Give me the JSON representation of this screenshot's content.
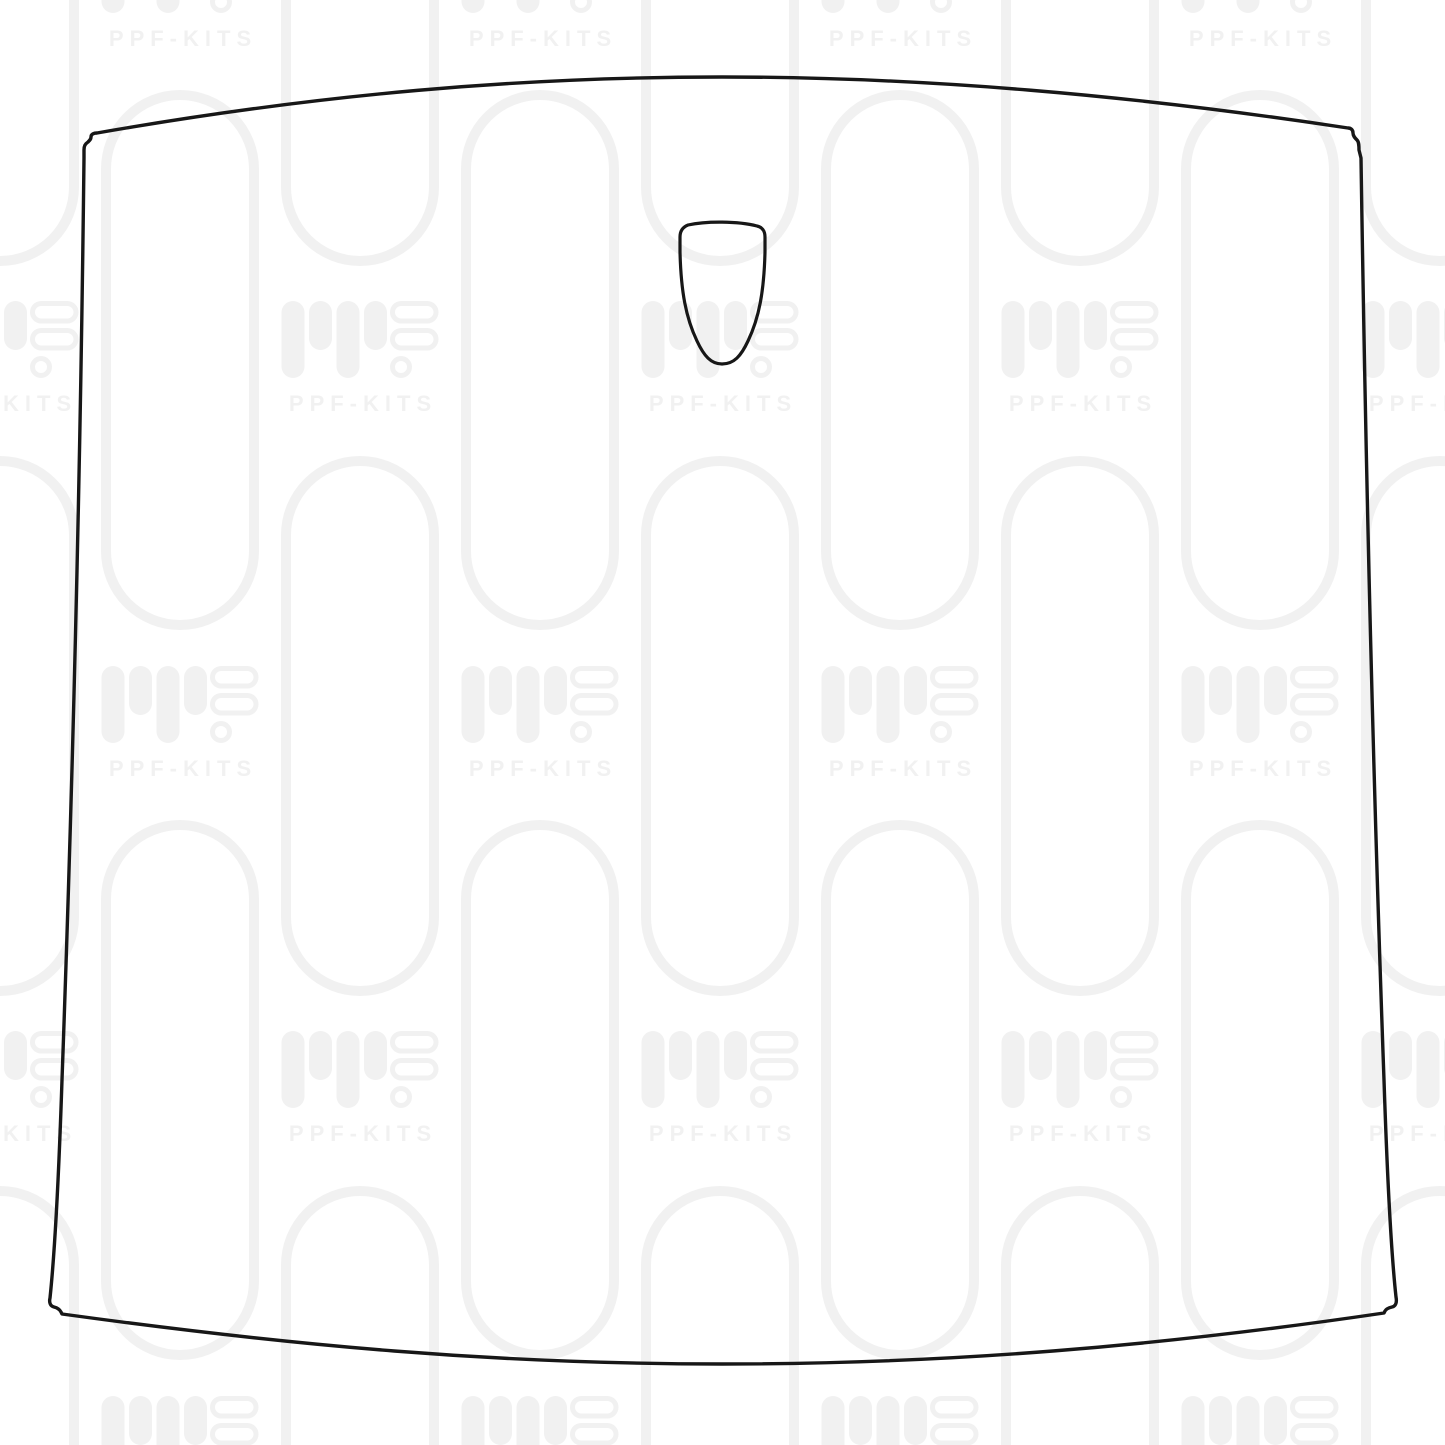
{
  "watermark": {
    "brand_text": "PPF-KITS",
    "logo_icon": "ppf-kits-equalizer-logo-icon",
    "pattern_shape": "capsule-tube-outline"
  },
  "template": {
    "main_shape": "car-hood-outline",
    "cutout_shape": "emblem-badge-cutout"
  },
  "colors": {
    "background": "#ffffff",
    "watermark": "#f1f1f1",
    "outline": "#171717"
  }
}
